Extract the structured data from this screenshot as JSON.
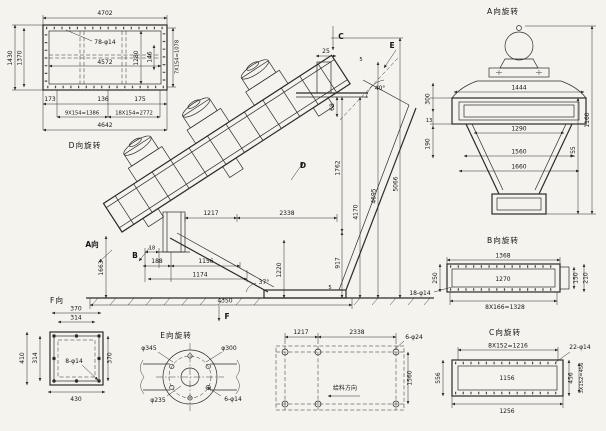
{
  "meta": {
    "bg": "#f4f3ee",
    "ink": "#2b2b2b",
    "type_label": "engineering-drawing-vibrating-screen"
  },
  "views": {
    "top_view": {
      "title": "D向旋转",
      "dims": {
        "overall_width": "4702",
        "inner_width": "4572",
        "holes": "78-φ14",
        "left_outer": "1430",
        "left_inner": "1370",
        "right_inner": "1280",
        "right_gap": "146",
        "right_pitch": "7X154=1078",
        "end_left": "173",
        "mid": "136",
        "end_right": "175",
        "pitch_a": "9X154=1386",
        "pitch_b": "18X154=2772",
        "bottom_width": "4642"
      }
    },
    "main_view": {
      "sections": {
        "a": "A向",
        "b": "B",
        "c": "C",
        "d": "D",
        "e": "E",
        "f": "F"
      },
      "dims": {
        "c_offset": "25",
        "gap_top": "5",
        "angle_top": "40°",
        "step": "68",
        "h_deck": "1762",
        "h_low": "917",
        "h_mid": "4170",
        "h_high": "4695",
        "h_total": "5066",
        "span_a": "1217",
        "span_b": "2338",
        "d18": "18",
        "d188": "188",
        "d1156": "1156",
        "d1174": "1174",
        "left_height": "1663",
        "outlet_height": "1220",
        "angle_bottom": "37°",
        "base_length": "4350",
        "gap_bottom": "5"
      }
    },
    "end_view": {
      "title": "A向旋转",
      "dims": {
        "top_width": "1444",
        "h_total": "1160",
        "h_body": "755",
        "left_a": "300",
        "left_b": "13",
        "left_c": "190",
        "w1": "1290",
        "w2": "1560",
        "w3": "1660"
      }
    },
    "b_view": {
      "title": "B向旋转",
      "dims": {
        "top": "1368",
        "inner": "1270",
        "pitch": "8X166=1328",
        "left": "250",
        "right_a": "150",
        "right_b": "210",
        "holes": "18-φ14"
      }
    },
    "c_view": {
      "title": "C向旋转",
      "dims": {
        "pitch": "8X152=1216",
        "holes": "22-φ14",
        "inner": "1156",
        "bottom": "1256",
        "left": "556",
        "right_a": "456",
        "right_b": "3X152=456"
      }
    },
    "e_view": {
      "title": "E向旋转",
      "dims": {
        "d1": "φ345",
        "d2": "φ300",
        "d3": "φ235",
        "holes": "6-φ14"
      }
    },
    "f_view": {
      "title": "F向",
      "dims": {
        "top_a": "370",
        "top_b": "314",
        "left_a": "410",
        "left_b": "314",
        "right": "370",
        "bottom": "430",
        "holes": "8-φ14"
      }
    },
    "plan_view": {
      "feed_label": "给料方向",
      "dims": {
        "span_a": "1217",
        "span_b": "2338",
        "holes": "6-φ24",
        "depth": "1560"
      }
    }
  }
}
